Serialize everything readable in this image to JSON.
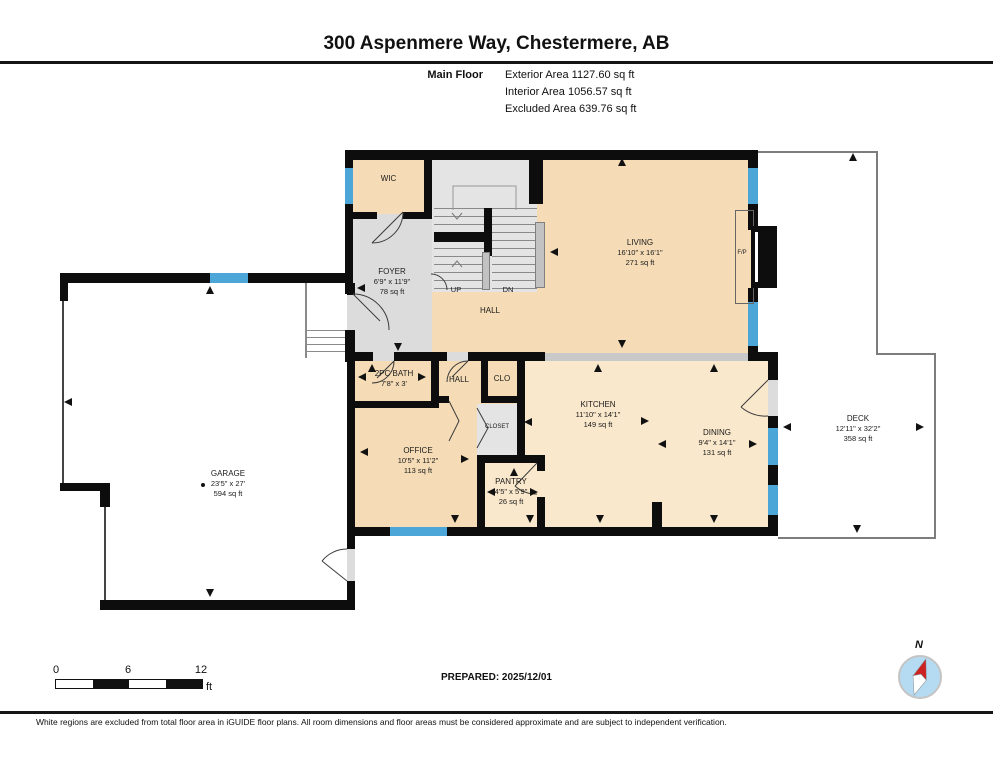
{
  "header": {
    "title": "300 Aspenmere Way, Chestermere, AB",
    "floor_label": "Main Floor",
    "area_lines": [
      "Exterior Area 1127.60 sq ft",
      "Interior Area 1056.57 sq ft",
      "Excluded Area 639.76 sq ft"
    ]
  },
  "rooms": {
    "wic": {
      "name": "WIC"
    },
    "foyer": {
      "name": "FOYER",
      "dims": "6'9\" x 11'9\"",
      "area": "78 sq ft"
    },
    "living": {
      "name": "LIVING",
      "dims": "16'10\" x 16'1\"",
      "area": "271 sq ft"
    },
    "hall_main": {
      "name": "HALL"
    },
    "stairs": {
      "up": "UP",
      "down": "DN"
    },
    "fireplace": {
      "name": "F/P"
    },
    "bath": {
      "name": "2PC BATH",
      "dims": "7'8\" x 3'"
    },
    "hall_small": {
      "name": "HALL"
    },
    "clo": {
      "name": "CLO"
    },
    "closet": {
      "name": "CLOSET"
    },
    "office": {
      "name": "OFFICE",
      "dims": "10'5\" x 11'2\"",
      "area": "113 sq ft"
    },
    "kitchen": {
      "name": "KITCHEN",
      "dims": "11'10\" x 14'1\"",
      "area": "149 sq ft"
    },
    "pantry": {
      "name": "PANTRY",
      "dims": "4'5\" x 5'9\"",
      "area": "26 sq ft"
    },
    "dining": {
      "name": "DINING",
      "dims": "9'4\" x 14'1\"",
      "area": "131 sq ft"
    },
    "garage": {
      "name": "GARAGE",
      "dims": "23'5\" x 27'",
      "area": "594 sq ft"
    },
    "deck": {
      "name": "DECK",
      "dims": "12'11\" x 32'2\"",
      "area": "358 sq ft"
    }
  },
  "footer": {
    "scale": {
      "tick0": "0",
      "tick1": "6",
      "tick2": "12",
      "unit": "ft"
    },
    "prepared": "PREPARED: 2025/12/01",
    "compass_label": "N",
    "disclaimer": "White regions are excluded from total floor area in iGUIDE floor plans. All room dimensions and floor areas must be considered approximate and are subject to independent verification."
  },
  "colors": {
    "room_tan": "#f5dcb6",
    "room_tan_light": "#fae8cc",
    "circulation_gray": "#dcdcdc",
    "stair_gray": "#e4e4e4",
    "window_blue": "#4da6d8",
    "wall_black": "#0d0d0d",
    "compass_blue": "#b5dbf2",
    "compass_red": "#cc2222"
  },
  "plan": {
    "arrows": [
      {
        "dir": "up",
        "x": 622,
        "y": 158
      },
      {
        "dir": "up",
        "x": 853,
        "y": 153
      },
      {
        "dir": "up",
        "x": 210,
        "y": 286
      },
      {
        "dir": "up",
        "x": 372,
        "y": 364
      },
      {
        "dir": "up",
        "x": 598,
        "y": 364
      },
      {
        "dir": "up",
        "x": 714,
        "y": 364
      },
      {
        "dir": "up",
        "x": 514,
        "y": 468
      },
      {
        "dir": "down",
        "x": 622,
        "y": 340
      },
      {
        "dir": "down",
        "x": 398,
        "y": 343
      },
      {
        "dir": "down",
        "x": 455,
        "y": 515
      },
      {
        "dir": "down",
        "x": 530,
        "y": 515
      },
      {
        "dir": "down",
        "x": 600,
        "y": 515
      },
      {
        "dir": "down",
        "x": 714,
        "y": 515
      },
      {
        "dir": "down",
        "x": 857,
        "y": 525
      },
      {
        "dir": "down",
        "x": 210,
        "y": 589
      },
      {
        "dir": "left",
        "x": 64,
        "y": 402
      },
      {
        "dir": "left",
        "x": 550,
        "y": 252
      },
      {
        "dir": "left",
        "x": 358,
        "y": 377
      },
      {
        "dir": "left",
        "x": 360,
        "y": 452
      },
      {
        "dir": "left",
        "x": 658,
        "y": 444
      },
      {
        "dir": "left",
        "x": 783,
        "y": 427
      },
      {
        "dir": "left",
        "x": 524,
        "y": 422
      },
      {
        "dir": "left",
        "x": 487,
        "y": 492
      },
      {
        "dir": "left",
        "x": 357,
        "y": 288
      },
      {
        "dir": "right",
        "x": 924,
        "y": 427
      },
      {
        "dir": "right",
        "x": 757,
        "y": 444
      },
      {
        "dir": "right",
        "x": 649,
        "y": 421
      },
      {
        "dir": "right",
        "x": 469,
        "y": 459
      },
      {
        "dir": "right",
        "x": 426,
        "y": 377
      },
      {
        "dir": "right",
        "x": 538,
        "y": 492
      }
    ]
  }
}
